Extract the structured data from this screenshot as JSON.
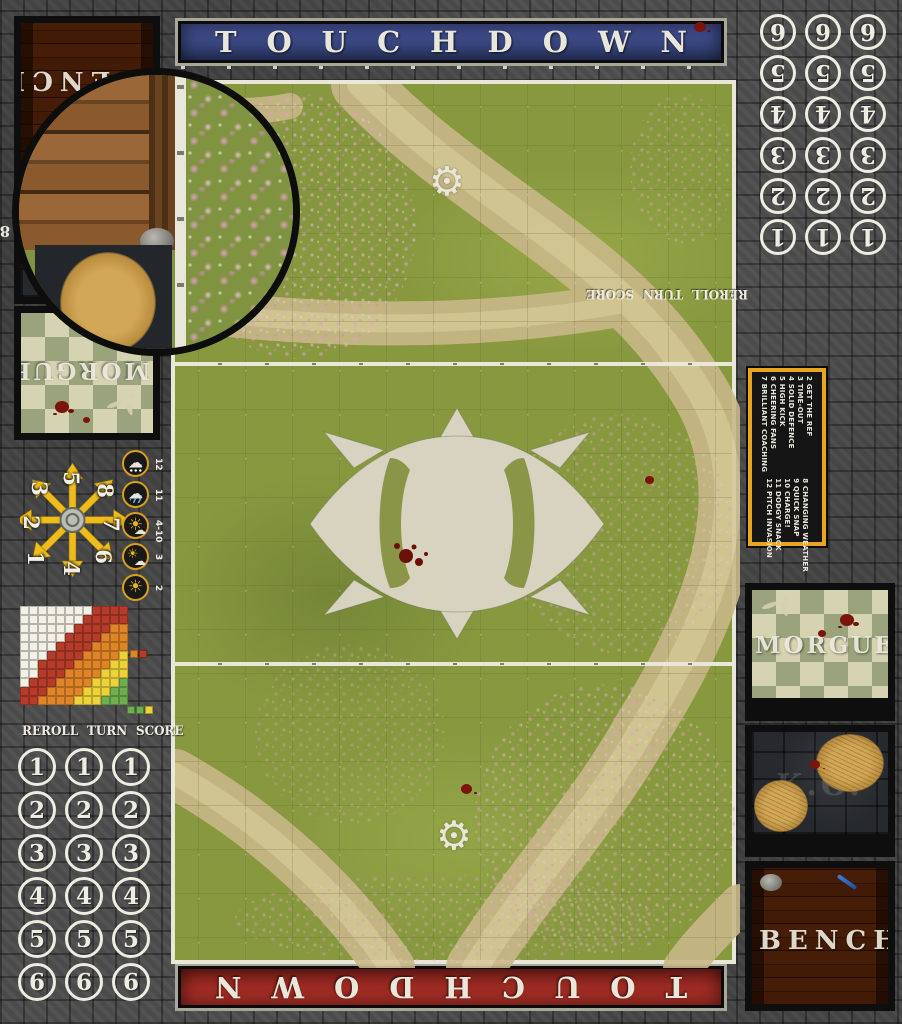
{
  "banners": {
    "top": "TOUCHDOWN",
    "bottom": "TOUCHDOWN"
  },
  "icons": {
    "gear_logo": "⚙",
    "sun": "☀",
    "cloud": "☁"
  },
  "left_sidebar": {
    "bench_label": "BENCH",
    "ko_label": "K.O.",
    "ko_range": "8-9",
    "morgue_label": "MORGUE",
    "morgue_range": "10-12",
    "scatter": {
      "numbers": [
        "1",
        "2",
        "3",
        "4",
        "5",
        "6",
        "7",
        "8"
      ]
    },
    "weather": {
      "rows": [
        {
          "value": "12",
          "icon": "blizzard"
        },
        {
          "value": "11",
          "icon": "rain"
        },
        {
          "value": "4-10",
          "icon": "sun-behind-cloud"
        },
        {
          "value": "3",
          "icon": "sun-with-cloud"
        },
        {
          "value": "2",
          "icon": "sun"
        }
      ]
    },
    "track_title": "REROLL TURN SCORE",
    "track_numbers": [
      "1",
      "2",
      "3",
      "4",
      "5",
      "6"
    ]
  },
  "right_sidebar": {
    "track_title": "REROLL TURN SCORE",
    "track_numbers": [
      "1",
      "2",
      "3",
      "4",
      "5",
      "6"
    ],
    "kickoff_table": {
      "col1": [
        "2 GET THE REF",
        "3 TIME-OUT",
        "4 SOLID DEFENCE",
        "5 HIGH KICK",
        "6 CHEERING FANS",
        "7 BRILLIANT COACHING"
      ],
      "col2": [
        "8 CHANGING WEATHER",
        "9 QUICK SNAP",
        "10 CHARGE!",
        "11 DODGY SNACK",
        "12 PITCH INVASION"
      ]
    },
    "morgue_label": "MORGUE",
    "morgue_range": "10-12",
    "ko_label": "K.O.",
    "ko_range": "8-9",
    "bench_label": "BENCH"
  },
  "chart_data": {
    "type": "heatmap",
    "title": "pass range ruler grid",
    "palette": {
      "W": "#f3f0e6",
      "R": "#b63c2a",
      "O": "#e08428",
      "Y": "#eed23a",
      "G": "#6fae4e"
    },
    "grid": [
      "WWWWWWWWRRRR",
      "WWWWWWWRRRRR",
      "WWWWWWRRRROO",
      "WWWWWRRRROOO",
      "WWWWRRRROOOO",
      "WWWRRRROOOOY",
      "WWRRRROOOOYY",
      "WWRRROOOOYYY",
      "WRRROOOOYYYG",
      "RRROOOOYYYGG",
      "RROOOOYYYGGG"
    ],
    "legend_pair": [
      "O",
      "R"
    ],
    "legend_trio": [
      "G",
      "G",
      "Y"
    ]
  },
  "colors": {
    "banner_blue": "#39467f",
    "banner_red": "#9c2a22",
    "pitch_green": "#87983f",
    "chalk_white": "#e9e6da",
    "kickoff_frame_orange": "#e9a51f",
    "stone_grey": "#4b4b4b"
  }
}
